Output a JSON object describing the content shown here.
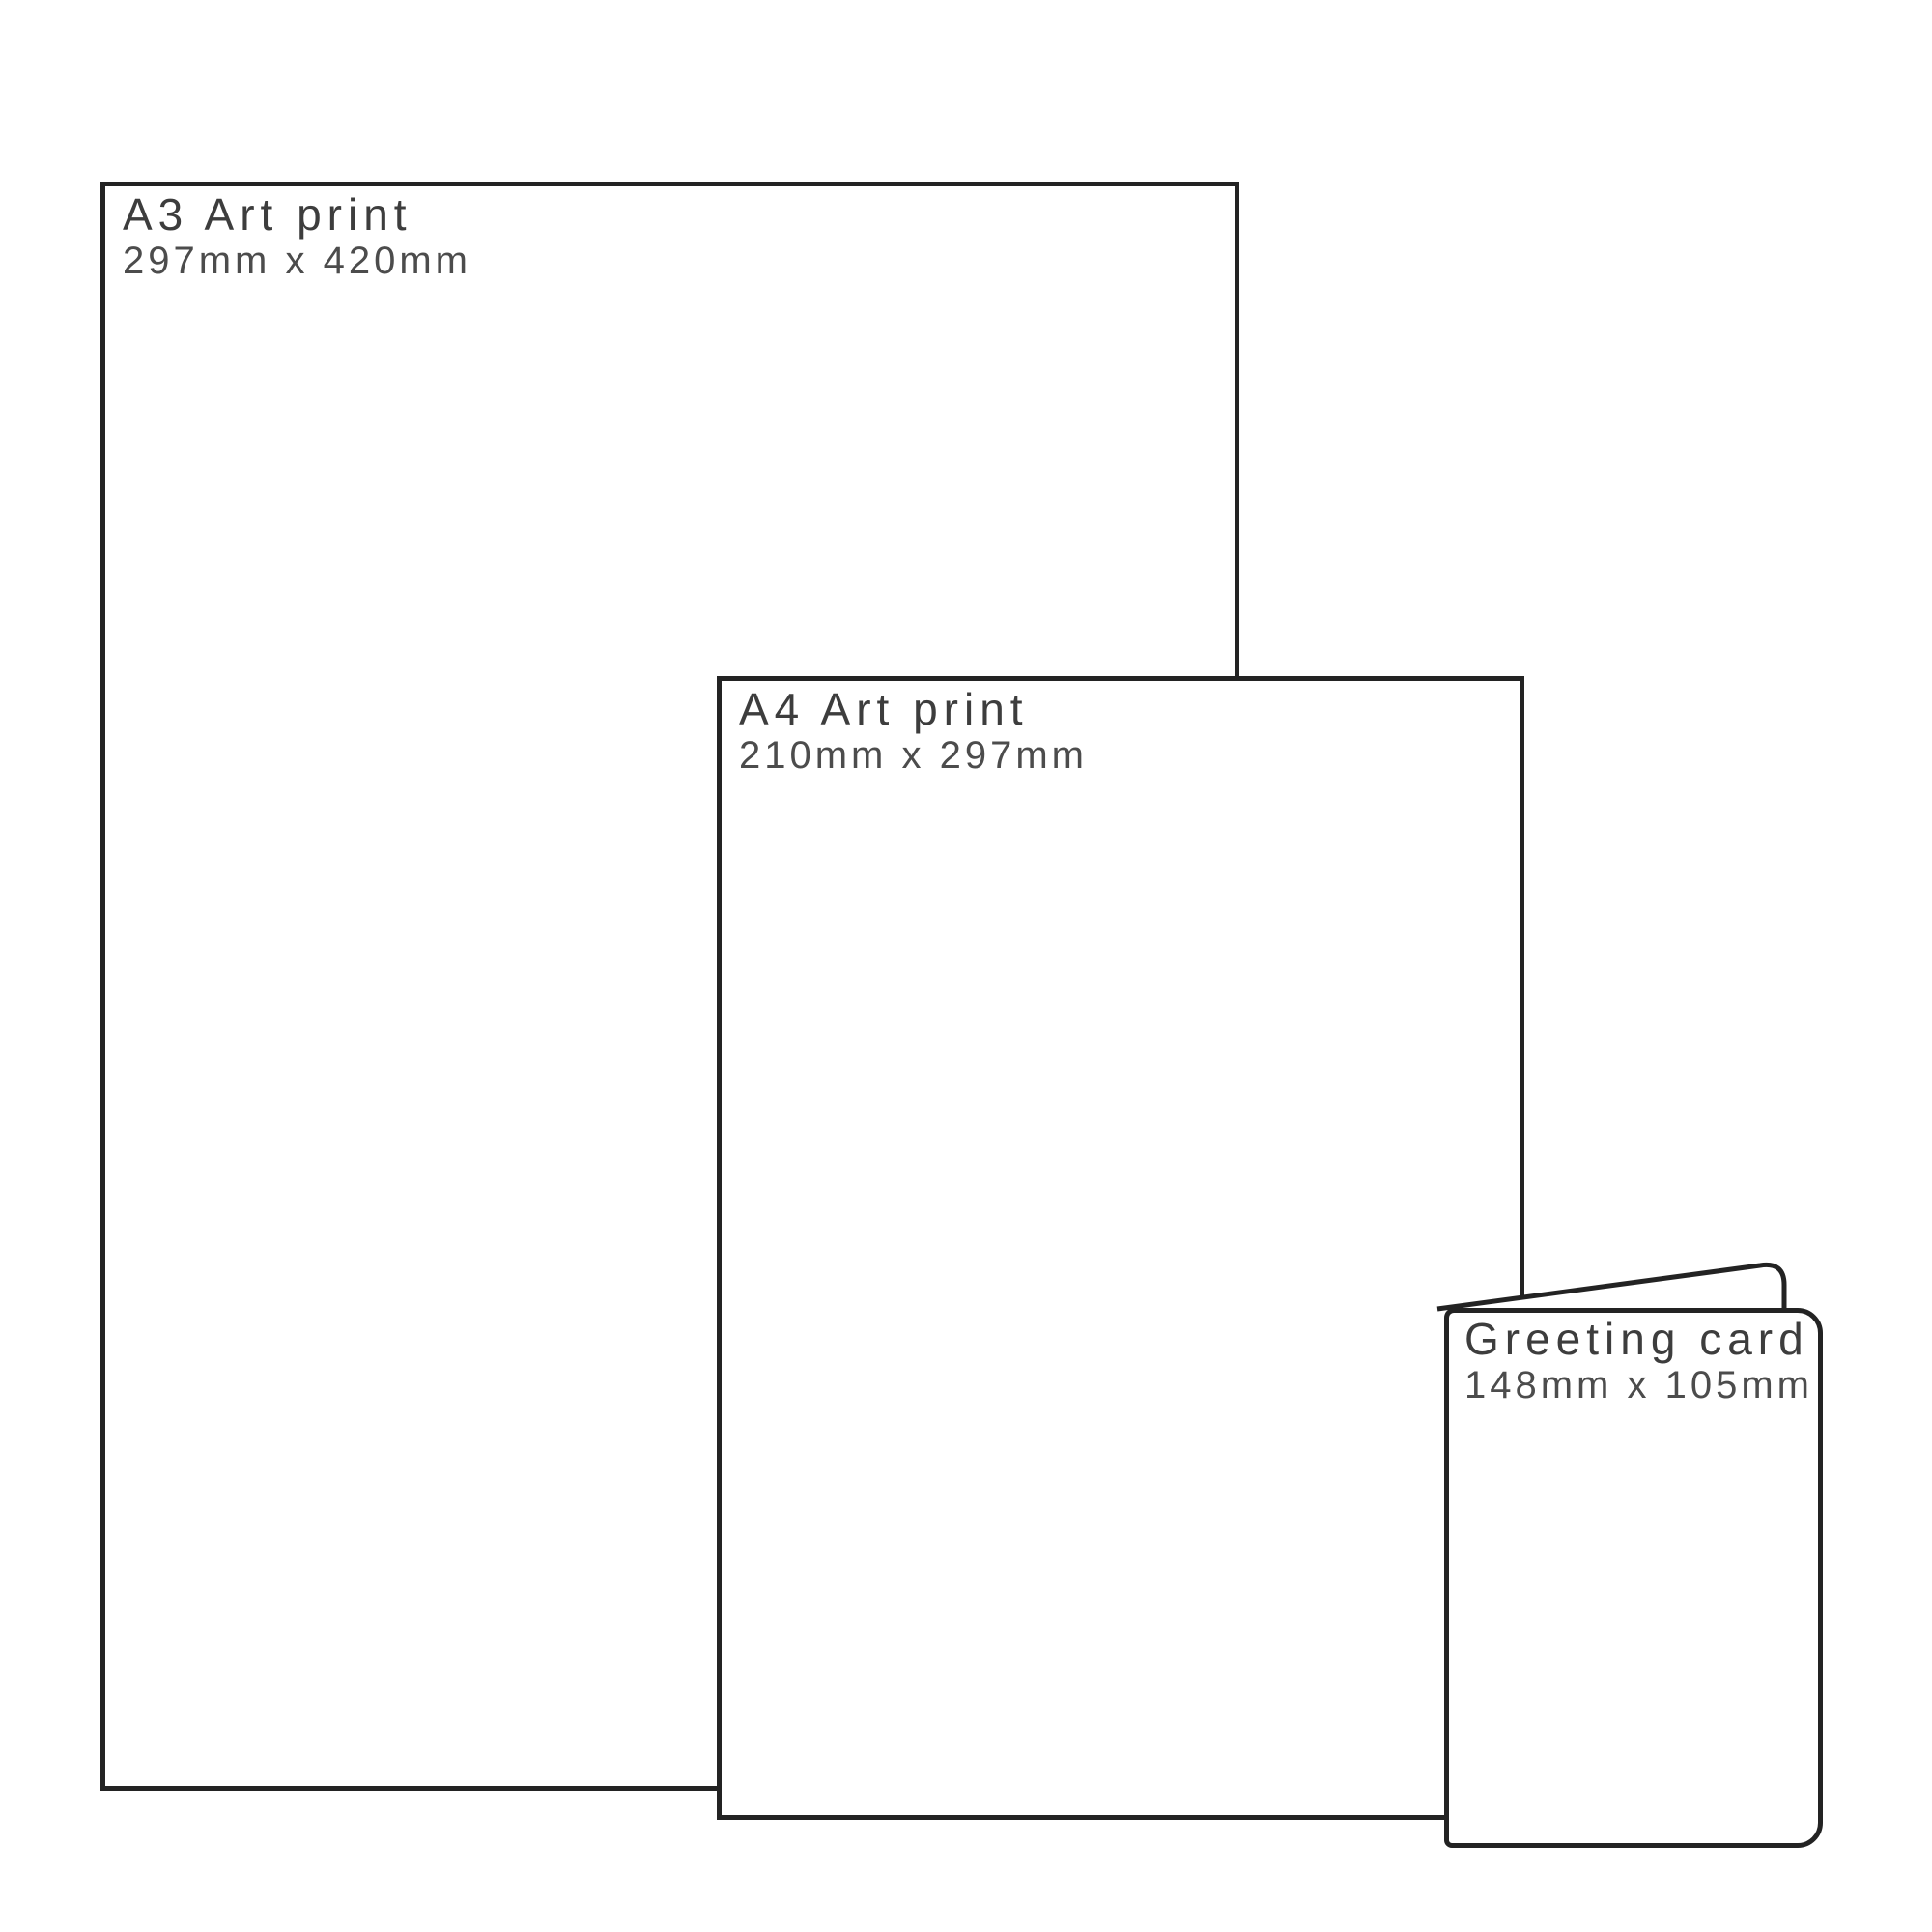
{
  "diagram": {
    "background_color": "#ffffff",
    "outline_color": "#232323",
    "title_color": "#3d3d3d",
    "dimension_color": "#4c4c4c"
  },
  "items": [
    {
      "id": "a3-art-print",
      "label": "A3 Art print",
      "dimensions": "297mm x 420mm"
    },
    {
      "id": "a4-art-print",
      "label": "A4 Art print",
      "dimensions": "210mm x 297mm"
    },
    {
      "id": "greeting-card",
      "label": "Greeting card",
      "dimensions": "148mm x 105mm"
    }
  ]
}
